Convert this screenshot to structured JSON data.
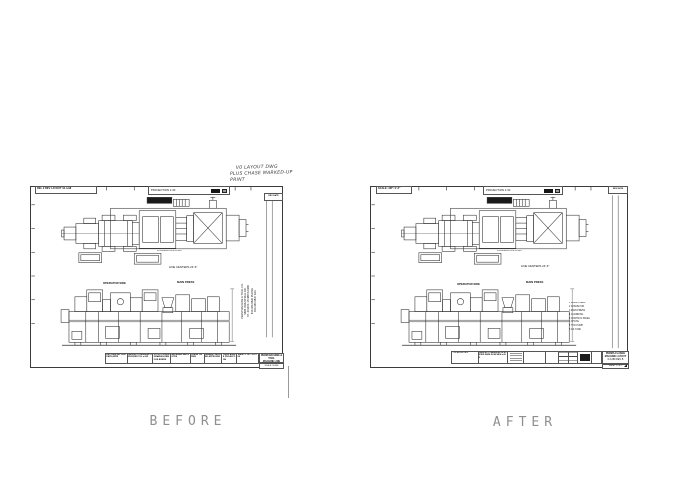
{
  "colors": {
    "ink": "#2a2a2a",
    "frame": "#3b3b3b",
    "label_gray": "#8f8f8f"
  },
  "compare_labels": {
    "before": "BEFORE",
    "after": "AFTER"
  },
  "annotation": {
    "line1": "V0 LAYOUT DWG",
    "line2": "PLUS CHASE MARKED-UP PRINT"
  },
  "before_sheet": {
    "corner_label": "REL 2  REV LAYOUT 10-4-98",
    "projection_label": "PROJECTION  1:40",
    "rev_header": "REV  DATE",
    "plan_sublabel": "FOUNDATION PLAN",
    "plan_caption": "LINE CENTERS 24'-6\"",
    "side_label_left": "OPERATOR SIDE",
    "side_label_right": "MAIN PRESS",
    "company_lines": [
      "PERM MACHINE & TOOL CO.",
      "9666 INDUSTRIAL DR.",
      "ST. JOHNS, MI 48879-9280",
      "810-360-9820 PHONE",
      "810-360-9847 FAX"
    ],
    "title_cells": [
      "REV  DESCRIPTION  DATE  APPR",
      "UNLESS OTHERWISE SPECIFIED TOL ±.005",
      "DO NOT SCALE DRAWING REMOVE BURRS",
      "MATERIAL  SEE NOTES",
      "FINISH 125 RMS",
      "DRAWN  CHECKED  APPROVED",
      "THIRD ANGLE PROJECTION",
      "SHEET 1 OF 1  D-1289"
    ],
    "title_box": {
      "line1": "PERM MACHINE & TOOL",
      "line2": "MACHINE LINE LAYOUT",
      "line3": "D-1289  REV A",
      "sub": "SCALE: NONE"
    }
  },
  "after_sheet": {
    "corner_label": "SCALE: 3/8\"=1'-0\"",
    "projection_label": "PROJECTION  1:40",
    "corner_right": "REV  DATE",
    "plan_sublabel": "FOUNDATION PLAN",
    "plan_caption": "LINE CENTERS 24'-6\"",
    "side_label_left": "OPERATOR SIDE",
    "side_label_right": "MAIN PRESS",
    "notes": [
      "1  PRESS FEED",
      "2  CONVEYOR",
      "3  MAIN PRESS",
      "4  GUARDING",
      "5  CONTROL PANEL",
      "6  CHUTE",
      "7  HYD PUMP",
      "8  OIL TANK"
    ],
    "title_cells": {
      "label": "TOLERANCES:",
      "notes": "UNLESS OTHERWISE SPECIFIED DIMS IN INCHES ±.005"
    },
    "title_box": {
      "line1": "PERMA-FLANGE",
      "line2": "MACHINE LAYOUT",
      "line3": "D-1289  REV B",
      "sub": "SHEET 1 OF 1"
    }
  }
}
